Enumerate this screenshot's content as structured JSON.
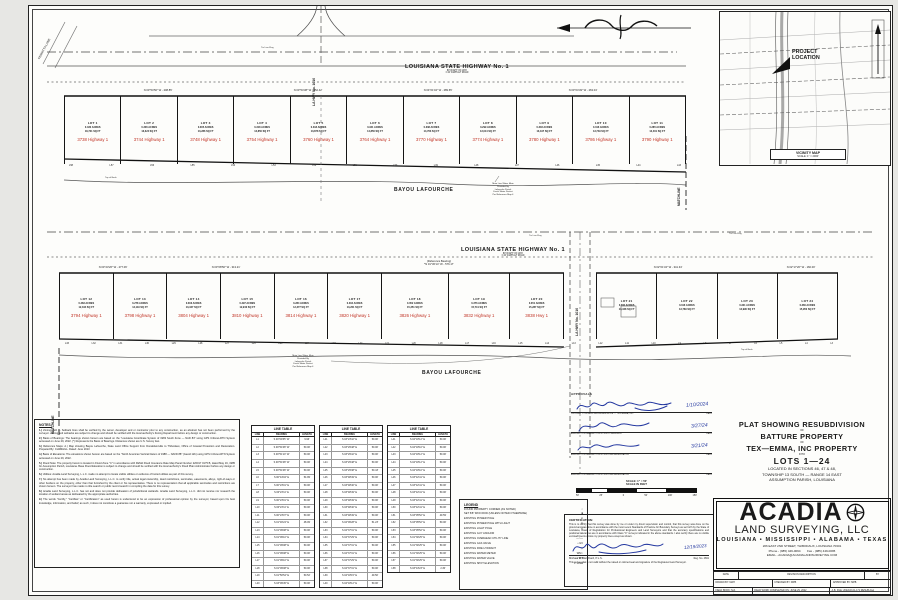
{
  "vicinity": {
    "project_location": "PROJECT\nLOCATION",
    "caption": "VICINITY MAP",
    "scale": "SCALE: 1\" = 2000'"
  },
  "bands": [
    {
      "left_label": "FERRITTA LANE",
      "side_road": "LA HWY No. 1010",
      "highway_label": "LOUISIANA STATE HIGHWAY No. 1",
      "row_sub1": "80' RIGHT OF WAY",
      "row_sub2": "± 40' ASPHALT ROAD",
      "bayou": "BAYOU LAFOURCHE",
      "matchline": "MATCHLINE",
      "top_of_bank": "Top of Bank",
      "tie_flag": "Tie Line Flag",
      "water_note": "Main Line Water Main\nProvided By\nLafourche Parish\nFresh Water District\nPer Reference Map 4",
      "bearings": [
        "N 03°54'50\" W - 208.85'",
        "N 03°54'38\" W - 252.42'",
        "N 04°01'04\" W - 289.65'",
        "N 03°04'49\" W - 263.04'"
      ],
      "lots": [
        {
          "lot": "LOT 1",
          "acres": "0.430 ACRES",
          "sqft": "18,721 SQ FT",
          "address": "3738 Highway 1"
        },
        {
          "lot": "LOT 2",
          "acres": "0.306 ACRES",
          "sqft": "13,324 SQ FT",
          "address": "3744 Highway 1"
        },
        {
          "lot": "LOT 3",
          "acres": "0.305 ACRES",
          "sqft": "13,286 SQ FT",
          "address": "3748 Highway 1"
        },
        {
          "lot": "LOT 4",
          "acres": "0.318 ACRES",
          "sqft": "13,850 SQ FT",
          "address": "3754 Highway 1"
        },
        {
          "lot": "LOT 5",
          "acres": "0.318 ACRES",
          "sqft": "13,878 SQ FT",
          "address": "3760 Highway 1"
        },
        {
          "lot": "LOT 6",
          "acres": "0.341 ACRES",
          "sqft": "14,856 SQ FT",
          "address": "3764 Highway 1"
        },
        {
          "lot": "LOT 7",
          "acres": "0.338 ACRES",
          "sqft": "14,763 SQ FT",
          "address": "3770 Highway 1"
        },
        {
          "lot": "LOT 8",
          "acres": "0.299 ACRES",
          "sqft": "13,014 SQ FT",
          "address": "3774 Highway 1"
        },
        {
          "lot": "LOT 9",
          "acres": "0.303 ACRES",
          "sqft": "13,197 SQ FT",
          "address": "3780 Highway 1"
        },
        {
          "lot": "LOT 10",
          "acres": "0.316 ACRES",
          "sqft": "13,749 SQ FT",
          "address": "3786 Highway 1"
        },
        {
          "lot": "LOT 11",
          "acres": "0.285 ACRES",
          "sqft": "12,401 SQ FT",
          "address": "3790 Highway 1"
        }
      ],
      "line_labels": [
        "L58",
        "L57",
        "L56",
        "L55",
        "L54",
        "L53",
        "L52",
        "L51",
        "L50",
        "L49",
        "L48",
        "L47",
        "L46",
        "L45",
        "L44",
        "L43"
      ]
    },
    {
      "side_road": "LA HWY No. 1010",
      "highway_label": "LOUISIANA STATE HIGHWAY No. 1",
      "row_sub1": "80' RIGHT OF WAY",
      "row_sub2": "± 40' ASPHALT ROAD",
      "bayou": "BAYOU LAFOURCHE",
      "matchline": "MATCHLINE",
      "top_of_bank": "Top of Bank",
      "tie_flag": "Tie Line Flag",
      "water_note": "Main Line Water Main\nProvided By\nLafourche Parish\nFresh Water District\nPer Reference Map 4",
      "bearings": [
        "N 03°23'26\" W - 277.06'",
        "N 03°08'50\" W - 313.21'",
        "(Reference Bearing)\n*N 01°36'14\" W - 576.17'",
        "N 02°01'34\" W - 341.34'",
        "N 02°17'20\" W - 160.00'"
      ],
      "lots": [
        {
          "lot": "LOT 12",
          "acres": "0.283 ACRES",
          "sqft": "12,344 SQ FT",
          "address": "3794 Highway 1"
        },
        {
          "lot": "LOT 13",
          "acres": "0.278 ACRES",
          "sqft": "12,119 SQ FT",
          "address": "3798 Highway 1"
        },
        {
          "lot": "LOT 14",
          "acres": "0.303 ACRES",
          "sqft": "13,347 SQ FT",
          "address": "3804 Highway 1"
        },
        {
          "lot": "LOT 15",
          "acres": "0.297 ACRES",
          "sqft": "12,940 SQ FT",
          "address": "3810 Highway 1"
        },
        {
          "lot": "LOT 16",
          "acres": "0.284 ACRES",
          "sqft": "12,377 SQ FT",
          "address": "3814 Highway 1"
        },
        {
          "lot": "LOT 17",
          "acres": "0.304 ACRES",
          "sqft": "13,261 SQ FT",
          "address": "3820 Highway 1"
        },
        {
          "lot": "LOT 18",
          "acres": "0.352 ACRES",
          "sqft": "15,351 SQ FT",
          "address": "3826 Highway 1"
        },
        {
          "lot": "LOT 19",
          "acres": "0.376 ACRES",
          "sqft": "15,741 SQ FT",
          "address": "3832 Highway 1"
        },
        {
          "lot": "LOT 20",
          "acres": "0.351 ACRES",
          "sqft": "15,287 SQ FT",
          "address": "3838 Hwy 1"
        }
      ],
      "lots_b": [
        {
          "lot": "LOT 21",
          "acres": "0.306 ACRES",
          "sqft": "13,348 SQ FT",
          "address": ""
        },
        {
          "lot": "LOT 22",
          "acres": "0.316 ACRES",
          "sqft": "13,769 SQ FT",
          "address": ""
        },
        {
          "lot": "LOT 23",
          "acres": "0.321 ACRES",
          "sqft": "13,990 SQ FT",
          "address": ""
        },
        {
          "lot": "LOT 24",
          "acres": "0.366 ACRES",
          "sqft": "15,950 SQ FT",
          "address": ""
        }
      ],
      "line_labels": [
        "L33",
        "L32",
        "L31",
        "L30",
        "L29",
        "L28",
        "L27",
        "L26",
        "L25",
        "L24",
        "L23",
        "L22",
        "L21",
        "L20",
        "L18",
        "L17",
        "L16",
        "L15",
        "L14",
        "L13",
        "L12",
        "L11",
        "L10",
        "L9",
        "L8",
        "L7",
        "L6",
        "L5",
        "L4",
        "L3"
      ]
    }
  ],
  "notes": {
    "title": "NOTES:",
    "items": [
      {
        "num": "1.)",
        "text": "Zoning: N/A — Setback lines shall be verified by the owner, developer and or contractor prior to any construction, as an abstract has not been performed by the surveyor. Zoning and setbacks are subject to change and should be verified with the local authority's Zoning Department before any design or construction."
      },
      {
        "num": "2.)",
        "text": "Basis of Bearings: The bearings shown hereon are based on the \"Louisiana Coordinate System of 1983 South Zone — NAD 83\" using GPS C4Gnet-RTN System accessed on June 29, 2022. (*) Represents the Basis of Bearings. Distances shown are U.S. Survey feet."
      },
      {
        "num": "3.)",
        "text": "Reference Maps: A.) Map showing Bayou Lafourche, State Land Office Support from Donaldsonville to Thibodaux, Office of Coastal Protection and Restoration. Prepared By: CH2MHILL. Dated: June 2013"
      },
      {
        "num": "4.)",
        "text": "Basis of Elevations: The elevations shown hereon are based on the \"North American Vertical Datum of 1988 — NAVD 88\" (Geoid 12b) using GPS C4Gnet-RTN System accessed on June 29, 2022."
      },
      {
        "num": "5.)",
        "text": "Flood Note: The property herein is located in Flood Zone \"C\" in accordance with FEMA Flood Insurance Rate Map Panel Number 220017 0175 B, dated May 19, 1985 for Assumption Parish, Louisiana. Base Flood Elevation is subject to change and should be verified with the local authority's Flood Plain Administrator before any design or construction."
      },
      {
        "num": "6.)",
        "text": "Utilities: Acadia Land Surveying, L.L.C. made no attempt to locate visible utilities or evidence of buried utilities as part of this survey."
      },
      {
        "num": "7.)",
        "text": "No attempt has been made by Acadia Land Surveying, L.L.C. to verify title, actual legal ownership, deed restrictions, servitudes, easements, alleys, right-of-ways or other burdens on the property, other than that furnished by the client or his representative. There is no representation that all applicable servitudes and restrictions are shown hereon. The surveyor has made no title search or public record search in compiling the data for this survey."
      },
      {
        "num": "8.)",
        "text": "Acadia Land Surveying, L.L.C. has not and does not provide delineation of jurisdictional wetlands. Acadia Land Surveying, L.L.C. did not receive nor research the location of wetland areas as delineated by the appropriate authorities."
      },
      {
        "num": "9.)",
        "text": "The words \"Certify,\" \"Certifies\" or \"Certification\" as used herein is understood to be an expression of professional opinion by the surveyor, based upon his best knowledge, information, and belief; as such, it does not constitute a guarantee nor a warranty, expressed or implied."
      }
    ]
  },
  "line_tables": {
    "title": "LINE TABLE",
    "headers": [
      "LINE",
      "BEARING",
      "LENGTH"
    ],
    "t1": [
      [
        "L1",
        "S 00°09'35\" W",
        "9.96'"
      ],
      [
        "L2",
        "S 00°51'08\" W",
        "50.00'"
      ],
      [
        "L3",
        "S 00°51'10\" W",
        "50.00'"
      ],
      [
        "L4",
        "S 00°51'08\" W",
        "50.00'"
      ],
      [
        "L5",
        "S 00°51'08\" W",
        "50.00'"
      ],
      [
        "L6",
        "S 00°44'04\" E",
        "54.99'"
      ],
      [
        "L7",
        "S 00°23'01\" E",
        "50.00'"
      ],
      [
        "L8",
        "S 00°23'11\" E",
        "50.00'"
      ],
      [
        "L9",
        "S 00°23'01\" E",
        "50.00'"
      ],
      [
        "L10",
        "S 00°23'11\" E",
        "50.00'"
      ],
      [
        "L11",
        "S 00°23'07\" E",
        "50.00'"
      ],
      [
        "L12",
        "S 01°46'24\" E",
        "48.09'"
      ],
      [
        "L13",
        "S 01°09'08\" E",
        "50.00'"
      ],
      [
        "L14",
        "S 01°09'10\" E",
        "50.00'"
      ],
      [
        "L15",
        "S 01°09'08\" E",
        "50.00'"
      ],
      [
        "L16",
        "S 01°09'08\" E",
        "50.00'"
      ],
      [
        "L17",
        "S 01°09'10\" E",
        "50.00'"
      ],
      [
        "L18",
        "S 01°09'08\" E",
        "50.00'"
      ],
      [
        "L19",
        "S 01°50'54\" E",
        "50.52'"
      ],
      [
        "L20",
        "S 03°09'45\" E",
        "50.00'"
      ]
    ],
    "t2": [
      [
        "L21",
        "S 03°23'42\" E",
        "50.00'"
      ],
      [
        "L22",
        "S 03°29'48\" E",
        "50.00'"
      ],
      [
        "L23",
        "S 03°29'42\" E",
        "50.00'"
      ],
      [
        "L24",
        "S 03°29'48\" E",
        "50.00'"
      ],
      [
        "L25",
        "S 03°29'38\" E",
        "50.43'"
      ],
      [
        "L26",
        "S 03°48'49\" E",
        "50.00'"
      ],
      [
        "L27",
        "S 03°48'46\" E",
        "50.00'"
      ],
      [
        "L28",
        "S 03°48'49\" E",
        "50.00'"
      ],
      [
        "L29",
        "S 03°48'49\" E",
        "50.00'"
      ],
      [
        "L30",
        "S 03°48'46\" E",
        "50.00'"
      ],
      [
        "L31",
        "S 03°48'49\" E",
        "50.00'"
      ],
      [
        "L32",
        "S 04°09'28\" E",
        "51.23'"
      ],
      [
        "L33",
        "S 04°37'31\" E",
        "50.00'"
      ],
      [
        "L34",
        "S 04°37'29\" E",
        "50.00'"
      ],
      [
        "L35",
        "S 04°37'31\" E",
        "50.00'"
      ],
      [
        "L36",
        "S 04°37'31\" E",
        "50.00'"
      ],
      [
        "L37",
        "S 04°37'29\" E",
        "50.00'"
      ],
      [
        "L38",
        "S 04°37'31\" E",
        "50.00'"
      ],
      [
        "L39",
        "S 04°18'15\" E",
        "49.50'"
      ],
      [
        "L40",
        "S 04°18'12\" E",
        "50.00'"
      ]
    ],
    "t3": [
      [
        "L41",
        "S 04°18'12\" E",
        "50.00'"
      ],
      [
        "L42",
        "S 04°18'10\" E",
        "50.00'"
      ],
      [
        "L43",
        "S 04°18'12\" E",
        "50.00'"
      ],
      [
        "L44",
        "S 04°18'12\" E",
        "50.00'"
      ],
      [
        "L45",
        "S 04°18'10\" E",
        "50.00'"
      ],
      [
        "L46",
        "S 03°42'41\" E",
        "50.00'"
      ],
      [
        "L47",
        "S 03°42'41\" E",
        "50.00'"
      ],
      [
        "L48",
        "S 03°42'41\" E",
        "50.00'"
      ],
      [
        "L49",
        "S 03°42'41\" E",
        "50.00'"
      ],
      [
        "L50",
        "S 03°42'41\" E",
        "50.00'"
      ],
      [
        "L51",
        "S 03°05'52\" E",
        "49.59'"
      ],
      [
        "L52",
        "S 03°05'52\" E",
        "50.00'"
      ],
      [
        "L53",
        "S 03°05'52\" E",
        "50.00'"
      ],
      [
        "L54",
        "S 01°30'25\" E",
        "50.00'"
      ],
      [
        "L55",
        "S 01°30'25\" E",
        "50.00'"
      ],
      [
        "L56",
        "S 01°30'25\" E",
        "50.00'"
      ],
      [
        "L57",
        "S 01°30'25\" E",
        "50.00'"
      ],
      [
        "L58",
        "S 03°43'23\" E",
        "2.30'"
      ]
    ]
  },
  "legend": {
    "title": "LEGEND",
    "items": [
      {
        "label": "FOUND PROPERTY CORNER (AS NOTED)",
        "sym": "○"
      },
      {
        "label": "SET 5/8\" IRON ROD (UNLESS NOTED OTHERWISE)",
        "sym": "■"
      },
      {
        "label": "EXISTING POWER POLE",
        "sym": "⊘"
      },
      {
        "label": "EXISTING POWER POLE WITH LIGHT",
        "sym": "⊗"
      },
      {
        "label": "EXISTING LIGHT POLE",
        "sym": "⊙"
      },
      {
        "label": "EXISTING GUY ANCHOR",
        "sym": "←"
      },
      {
        "label": "EXISTING OVERHEAD UTILITY LINE",
        "sym": "—○—"
      },
      {
        "label": "EXISTING GAS VALVE",
        "sym": "▪ GV"
      },
      {
        "label": "EXISTING FIRE HYDRANT",
        "sym": "◇"
      },
      {
        "label": "EXISTING WATER METER",
        "sym": "WM ▫"
      },
      {
        "label": "EXISTING WATER VALVE",
        "sym": "▪ WV"
      },
      {
        "label": "EXISTING SPOT ELEVATION",
        "sym": "✕ 10.00"
      }
    ]
  },
  "approvals": {
    "title": "APPROVALS",
    "date_label": "DATE",
    "rows": [
      {
        "label": "PROPERTY OWNERS REPRESENTATIVE — TEX-EMMA, INC.",
        "date": "1/10/2024"
      },
      {
        "label": "ASSUMPTION PARISH POLICE JURY PRESIDENT",
        "date": "3/27/24"
      },
      {
        "label": "ASSUMPTION PARISH POLICE JURY REPRESENTATIVE",
        "date": "3/21/24"
      },
      {
        "label": "ASSUMPTION PARISH POLICE JURY REPRESENTATIVE",
        "date": ""
      }
    ]
  },
  "scalebar": {
    "line1": "SCALE: 1\" = 50'",
    "line2": "SCALE IN FEET",
    "ticks": [
      "50'",
      "25'",
      "0",
      "50'",
      "100'",
      "150'"
    ]
  },
  "certification": {
    "title": "CERTIFICATION:",
    "body": "This is to certify that this survey was done by me or under my direct supervision and control, that this survey was done on the ground and was done in accordance with the most recent Standards of Practice for Boundary Surveys as set forth by the State of Louisiana, Board of Registration for Professional Engineers and Land Surveyors and that the accuracy specifications and positional tolerances are in accordance with Class \"C\" surveys indicated in the above standards. I also certify there are no visible encroachments across my property lines except as shown.",
    "name": "Michael P. Blanchard, P.L.S.",
    "date": "12/19/2023",
    "reg": "Reg. No. 4661",
    "disclaimer": "This survey plat is not valid without the raised or colored seal and signature of the Registered Land Surveyor."
  },
  "titleblock": {
    "line1": "PLAT SHOWING RESUBDIVISION",
    "of1": "OF",
    "line2": "BATTURE PROPERTY",
    "of2": "OF",
    "line3": "TEX—EMMA, INC PROPERTY",
    "into": "INTO",
    "lots": "LOTS 1—24",
    "loc1": "LOCATED IN SECTIONS 46, 47 & 48,",
    "loc2": "TOWNSHIP 13 SOUTH — RANGE 14 EAST",
    "loc3": "ASSUMPTION PARISH, LOUISIANA"
  },
  "firm": {
    "name": "ACADIA",
    "sub": "LAND SURVEYING, LLC",
    "states": "LOUISIANA • MISSISSIPPI • ALABAMA • TEXAS",
    "addr": "206 EAST 2ND STREET, THIBODAUX, LOUISIANA 70301",
    "phone_fax": "Phone - (985) 449-0094        Fax - (985) 449-0095",
    "email": "EMAIL - ACADIA@ACADIALANDSURVEYING.COM"
  },
  "revision": {
    "r1": [
      "DATE",
      "REVISION DESCRIPTION",
      "BY"
    ],
    "r2": [
      "DRAWN BY: MAH",
      "CHECKED BY: MPB",
      "APPROVED BY: MPB"
    ],
    "r3": [
      "FIELD BOOK: N/A",
      "FIELD WORK COMPLETED ON: JUNE 29, 2022",
      "A.B. FILE: 2022/22-01-171 RESUB.dwg"
    ]
  }
}
